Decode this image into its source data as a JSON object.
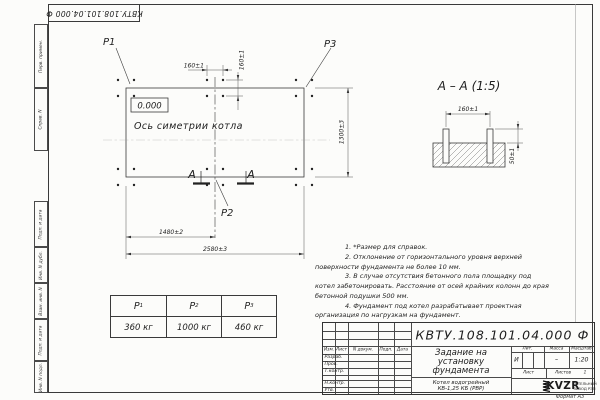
{
  "sheet": {
    "designation_top": "КВТУ.108.101.04.000 Ф",
    "format_label": "Формат А3",
    "margin_boxes": [
      "Перв. примен.",
      "Справ. N",
      "Подп. и дата",
      "Инв. N дубл.",
      "Взам. инв. N",
      "Подп. и дата",
      "Инв. N подл."
    ]
  },
  "plan": {
    "elevation": "0.000",
    "axis_label": "Ось симетрии котла",
    "point_labels": {
      "p1": "P1",
      "p2": "P2",
      "p3": "P3"
    },
    "section_letter": "А",
    "dims": {
      "bolt_spacing_h": "160±1",
      "bolt_spacing_v": "160±1",
      "width": "1300±3",
      "length_to_axis": "1480±2",
      "length_total": "2580±3"
    }
  },
  "section_view": {
    "title": "А – А (1:5)",
    "dims": {
      "bolt_spacing": "160±1",
      "bolt_height": "50±1"
    }
  },
  "notes": [
    "1. *Размер для справок.",
    "2. Отклонение от горизонтального уровня верхней поверхности фундамента не более 10 мм.",
    "3. В случае отсутствия бетонного пола площадку под котел забетонировать. Расстояние от осей крайних колонн до края бетонной подушки 500 мм.",
    "4. Фундамент под котел разрабатывает проектная организация по нагрузкам на фундамент."
  ],
  "load_table": {
    "columns": [
      {
        "symbol": "P",
        "sub": "1",
        "value": "360 кг"
      },
      {
        "symbol": "P",
        "sub": "2",
        "value": "1000 кг"
      },
      {
        "symbol": "P",
        "sub": "3",
        "value": "460 кг"
      }
    ]
  },
  "title_block": {
    "designation": "КВТУ.108.101.04.000 Ф",
    "doc_title": [
      "Задание на",
      "установку",
      "фундамента"
    ],
    "product": [
      "Котел водогрейный",
      "КВ-1,25 КБ (РВР)"
    ],
    "header_cols": [
      "Изм.",
      "Лист",
      "N докум.",
      "Подп.",
      "Дата"
    ],
    "signature_rows": [
      "Разраб.",
      "Пров.",
      "Т.контр.",
      "",
      "Н.контр.",
      "Утв."
    ],
    "lit_label": "Лит.",
    "lit_value": "И",
    "mass_label": "Масса",
    "mass_value": "–",
    "scale_label": "Масштаб",
    "scale_value": "1:20",
    "sheet_label": "Лист",
    "sheets_label": "Листов",
    "sheets_value": "1",
    "logo_text": "KVZR",
    "company": [
      "КОТЕЛЬНЫЙ",
      "ЗАВОД РЭП"
    ]
  }
}
